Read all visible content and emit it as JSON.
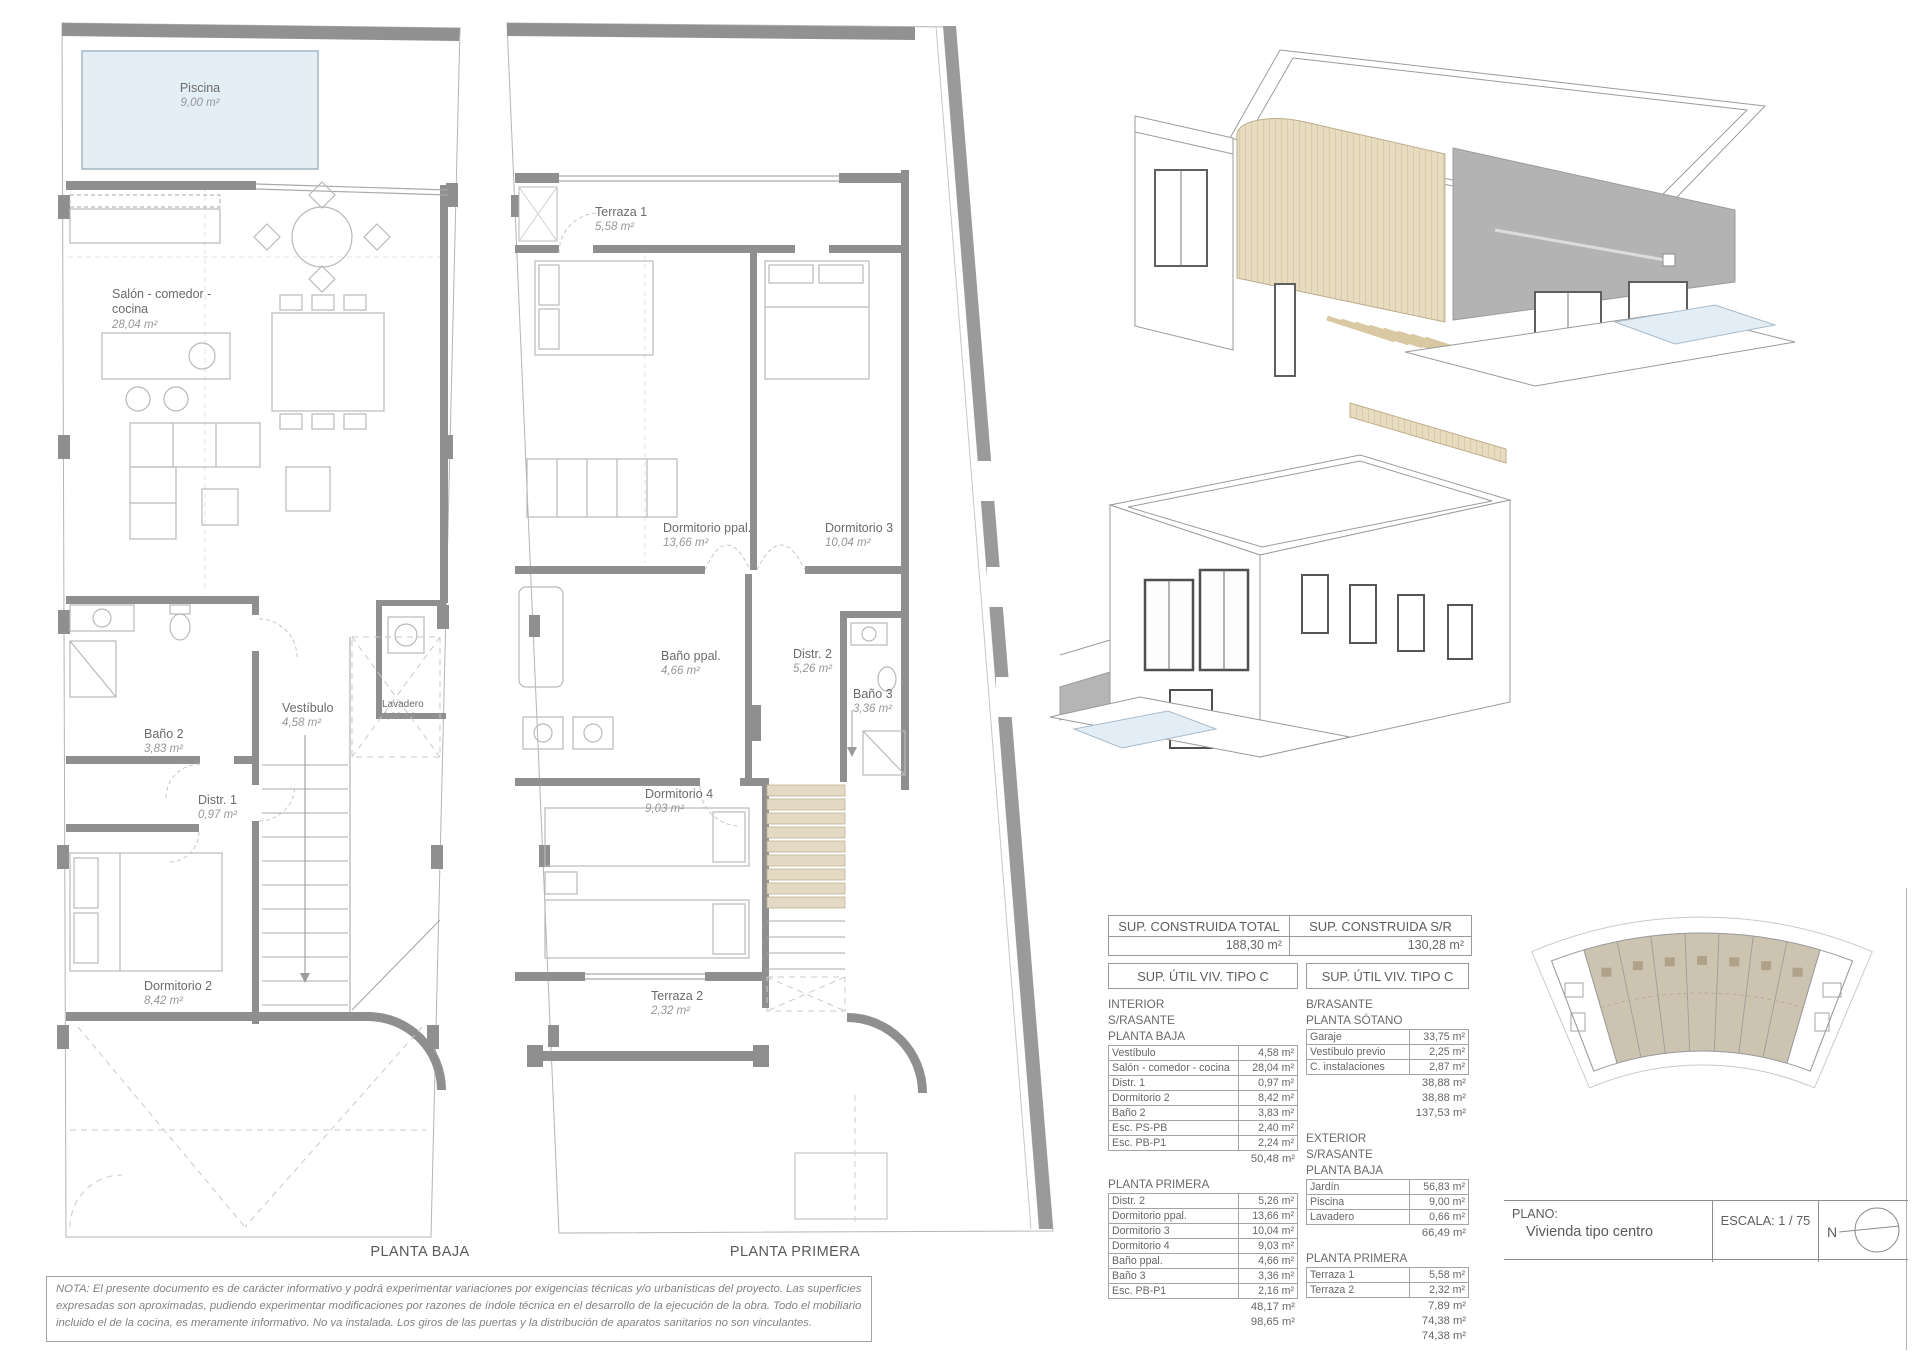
{
  "plans": [
    {
      "caption": "PLANTA BAJA",
      "rooms": [
        {
          "name": "Piscina",
          "area": "9,00 m²"
        },
        {
          "name": "Salón - comedor - cocina",
          "area": "28,04 m²"
        },
        {
          "name": "Vestíbulo",
          "area": "4,58 m²"
        },
        {
          "name": "Lavadero",
          "area": "0,66 m²"
        },
        {
          "name": "Baño 2",
          "area": "3,83 m²"
        },
        {
          "name": "Distr. 1",
          "area": "0,97 m²"
        },
        {
          "name": "Dormitorio 2",
          "area": "8,42 m²"
        }
      ]
    },
    {
      "caption": "PLANTA PRIMERA",
      "rooms": [
        {
          "name": "Terraza 1",
          "area": "5,58 m²"
        },
        {
          "name": "Dormitorio ppal.",
          "area": "13,66 m²"
        },
        {
          "name": "Dormitorio 3",
          "area": "10,04 m²"
        },
        {
          "name": "Baño ppal.",
          "area": "4,66 m²"
        },
        {
          "name": "Distr. 2",
          "area": "5,26 m²"
        },
        {
          "name": "Baño 3",
          "area": "3,36 m²"
        },
        {
          "name": "Dormitorio 4",
          "area": "9,03 m²"
        },
        {
          "name": "Terraza 2",
          "area": "2,32 m²"
        }
      ]
    }
  ],
  "summary": {
    "col1": {
      "header": "SUP. CONSTRUIDA TOTAL",
      "value": "188,30 m²"
    },
    "col2": {
      "header": "SUP. CONSTRUIDA S/R",
      "value": "130,28 m²"
    }
  },
  "util_left": {
    "header": "SUP. ÚTIL VIV. TIPO C",
    "blocks": [
      {
        "labels": [
          "INTERIOR",
          "S/RASANTE",
          "PLANTA BAJA"
        ],
        "rows": [
          [
            "Vestíbulo",
            "4,58 m²"
          ],
          [
            "Salón - comedor - cocina",
            "28,04 m²"
          ],
          [
            "Distr. 1",
            "0,97 m²"
          ],
          [
            "Dormitorio 2",
            "8,42 m²"
          ],
          [
            "Baño 2",
            "3,83 m²"
          ],
          [
            "Esc. PS-PB",
            "2,40 m²"
          ],
          [
            "Esc. PB-P1",
            "2,24 m²"
          ]
        ],
        "totals": [
          "50,48 m²"
        ]
      },
      {
        "labels": [
          "PLANTA PRIMERA"
        ],
        "rows": [
          [
            "Distr. 2",
            "5,26 m²"
          ],
          [
            "Dormitorio ppal.",
            "13,66 m²"
          ],
          [
            "Dormitorio 3",
            "10,04 m²"
          ],
          [
            "Dormitorio 4",
            "9,03 m²"
          ],
          [
            "Baño ppal.",
            "4,66 m²"
          ],
          [
            "Baño 3",
            "3,36 m²"
          ],
          [
            "Esc. PB-P1",
            "2,16 m²"
          ]
        ],
        "totals": [
          "48,17 m²",
          "98,65 m²"
        ]
      }
    ]
  },
  "util_right": {
    "header": "SUP. ÚTIL VIV. TIPO C",
    "blocks": [
      {
        "labels": [
          "B/RASANTE",
          "PLANTA SÓTANO"
        ],
        "rows": [
          [
            "Garaje",
            "33,75 m²"
          ],
          [
            "Vestíbulo previo",
            "2,25 m²"
          ],
          [
            "C. instalaciones",
            "2,87 m²"
          ]
        ],
        "totals": [
          "38,88 m²",
          "38,88 m²",
          "137,53 m²"
        ]
      },
      {
        "labels": [
          "EXTERIOR",
          "S/RASANTE",
          "PLANTA BAJA"
        ],
        "rows": [
          [
            "Jardín",
            "56,83 m²"
          ],
          [
            "Piscina",
            "9,00 m²"
          ],
          [
            "Lavadero",
            "0,66 m²"
          ]
        ],
        "totals": [
          "66,49 m²"
        ]
      },
      {
        "labels": [
          "PLANTA PRIMERA"
        ],
        "rows": [
          [
            "Terraza 1",
            "5,58 m²"
          ],
          [
            "Terraza 2",
            "2,32 m²"
          ]
        ],
        "totals": [
          "7,89 m²",
          "74,38 m²",
          "74,38 m²"
        ]
      }
    ]
  },
  "title_block": {
    "plano_label": "PLANO:",
    "plano_value": "Vivienda tipo centro",
    "escala": "ESCALA:  1 / 75",
    "north_label": "N"
  },
  "note": "NOTA: El presente documento es de carácter informativo y podrá experimentar variaciones por exigencias técnicas y/o urbanísticas del proyecto. Las superficies expresadas son aproximadas, pudiendo experimentar modificaciones por razones de índole técnica en el desarrollo de la ejecución de la obra. Todo el mobiliario incluido el de la cocina, es meramente informativo. No va instalada. Los giros de las puertas y la distribución de aparatos sanitarios no son vinculantes.",
  "colors": {
    "wall_gray": "#8f8f8f",
    "slat_beige": "#e7dcc0",
    "pool_blue": "#e4eef6",
    "site_tan": "#cdc3b1"
  }
}
